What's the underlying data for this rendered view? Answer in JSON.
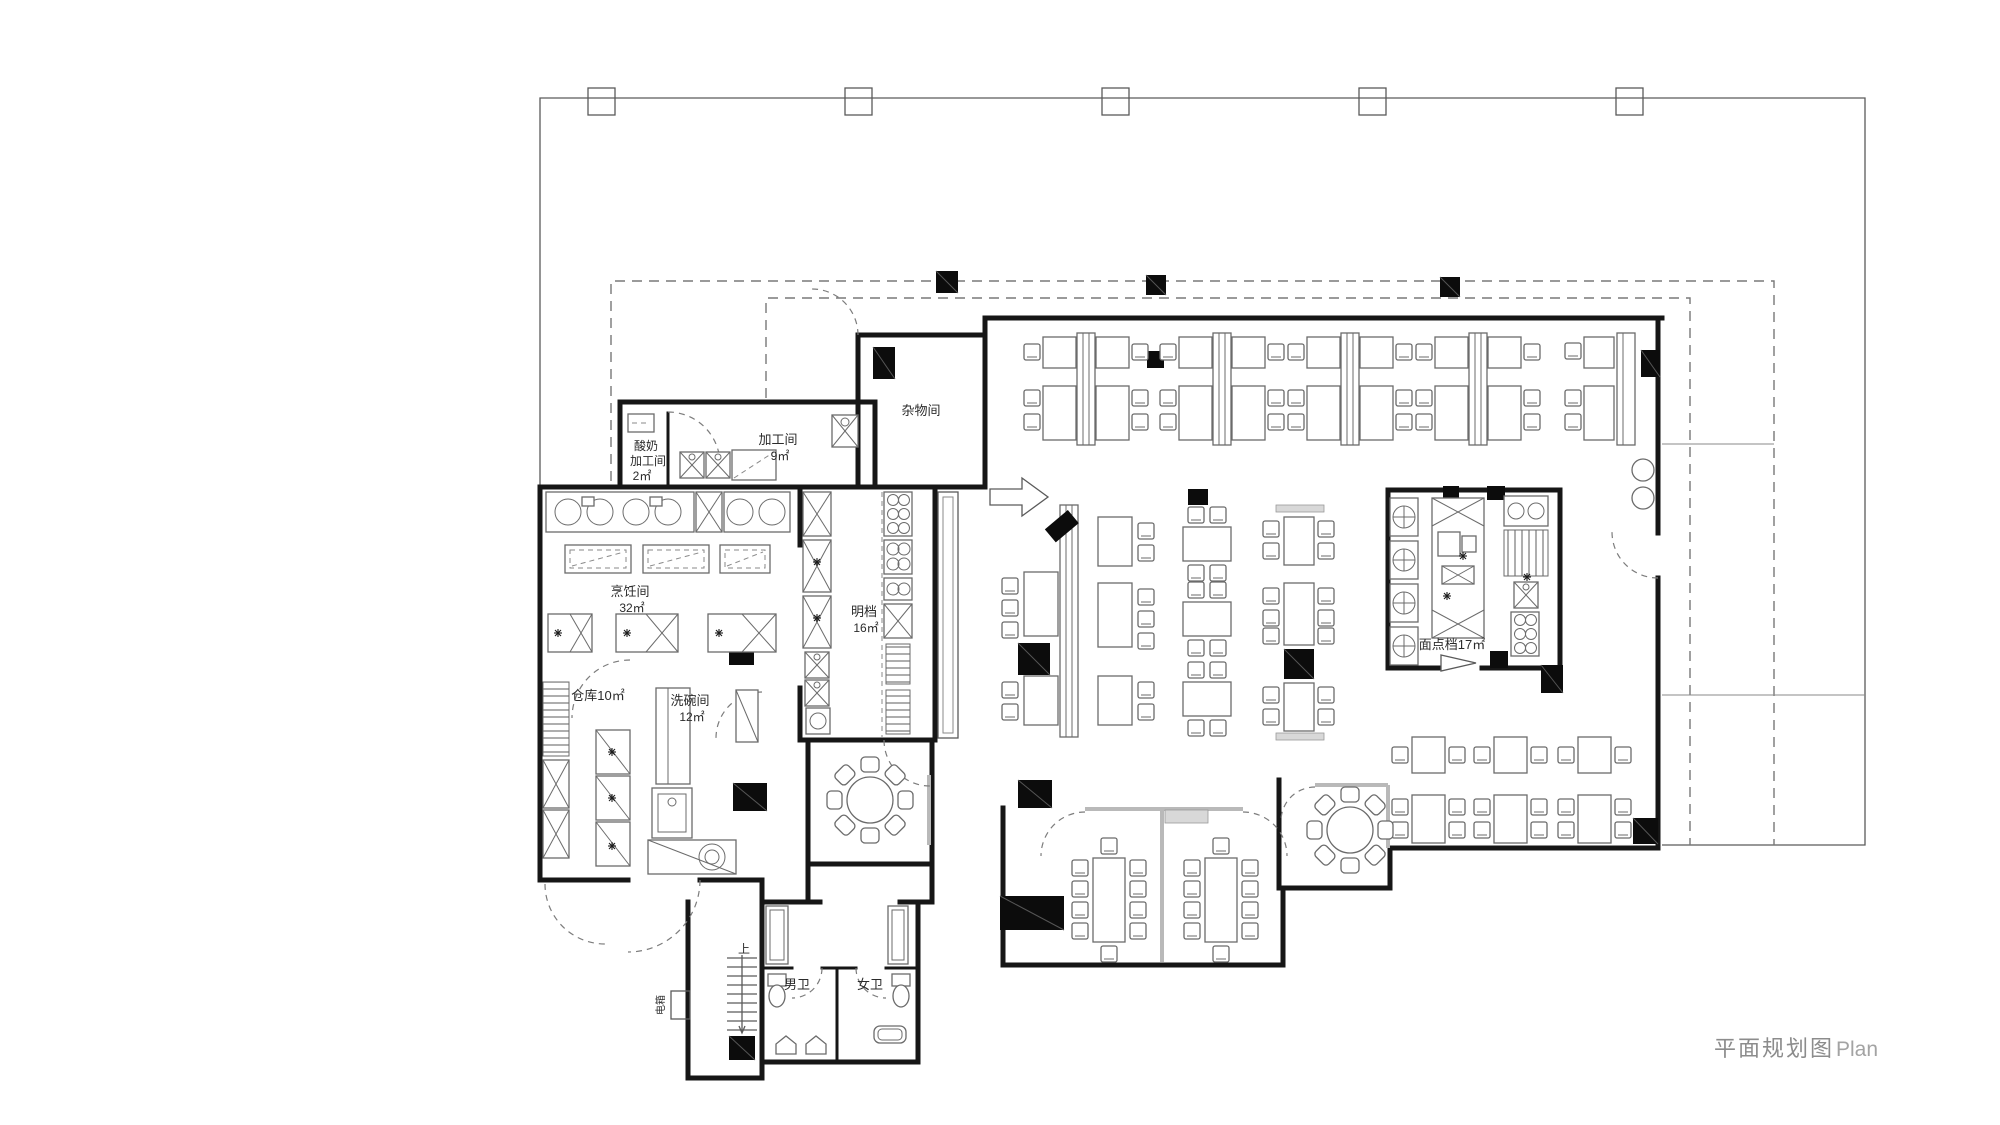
{
  "title": {
    "zh": "平面规划图",
    "en": "Plan"
  },
  "rooms": {
    "yogurt_processing": {
      "line1": "酸奶",
      "line2": "加工间",
      "line3": "2㎡"
    },
    "processing": {
      "name": "加工间",
      "area": "9㎡"
    },
    "cooking": {
      "name": "烹饪间",
      "area": "32㎡"
    },
    "storage": {
      "name": "仓库10㎡"
    },
    "dishwashing": {
      "name": "洗碗间",
      "area": "12㎡"
    },
    "open_counter": {
      "name": "明档",
      "area": "16㎡"
    },
    "sundry": {
      "name": "杂物间"
    },
    "pastry": {
      "name": "面点档17㎡"
    },
    "mens_toilet": {
      "name": "男卫"
    },
    "womens_toilet": {
      "name": "女卫"
    },
    "electric_box": {
      "name": "电箱"
    },
    "stairs": {
      "up_label": "上"
    }
  }
}
